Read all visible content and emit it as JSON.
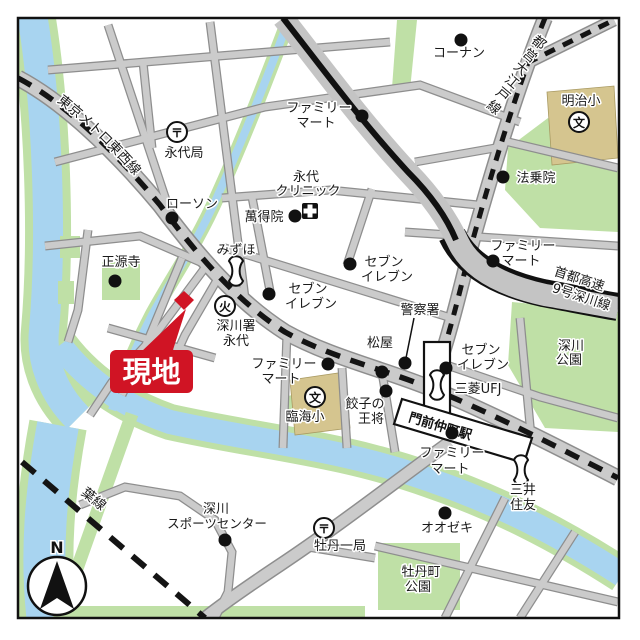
{
  "map": {
    "site": {
      "label": "現地"
    },
    "compass": {
      "north": "N"
    },
    "railways": {
      "tozai": "東京メトロ東西線",
      "oedo": "都営大江戸線",
      "oedo_chars": [
        "都",
        "営",
        "大",
        "江",
        "戸",
        "線"
      ],
      "keiyo": "京葉線",
      "expressway": [
        "首都高速",
        "9号深川線"
      ]
    },
    "station": {
      "name": "門前仲町駅"
    },
    "icons": {
      "post_office": "〒",
      "fire_station": "火",
      "school": "文"
    },
    "pois": {
      "konan": {
        "name": "コーナン"
      },
      "famima_top": {
        "lines": [
          "ファミリー",
          "マート"
        ]
      },
      "eidai_clinic": {
        "lines": [
          "永代",
          "クリニック"
        ]
      },
      "mantokuin": {
        "name": "萬得院"
      },
      "eidai_post": {
        "name": "永代局"
      },
      "lawson": {
        "name": "ローソン"
      },
      "hojoin": {
        "name": "法乗院"
      },
      "meiji_elementary": {
        "name": "明治小"
      },
      "famima_expressway": {
        "lines": [
          "ファミリー",
          "マート"
        ]
      },
      "shogenji": {
        "name": "正源寺"
      },
      "mizuho": {
        "name": "みずほ"
      },
      "seven_west": {
        "lines": [
          "セブン",
          "イレブン"
        ]
      },
      "seven_north": {
        "lines": [
          "セブン",
          "イレブン"
        ]
      },
      "fire_station_eitai": {
        "lines": [
          "深川署",
          "永代"
        ]
      },
      "police": {
        "name": "警察署"
      },
      "matsuya": {
        "name": "松屋"
      },
      "gyoza_ohsho": {
        "lines": [
          "餃子の",
          "王将"
        ]
      },
      "famima_center": {
        "lines": [
          "ファミリー",
          "マート"
        ]
      },
      "rinkai_elementary": {
        "name": "臨海小"
      },
      "seven_station": {
        "lines": [
          "セブン",
          "イレブン"
        ]
      },
      "mitsubishi_ufj": {
        "name": "三菱UFJ"
      },
      "fukagawa_park": {
        "lines": [
          "深川",
          "公園"
        ]
      },
      "famima_station": {
        "lines": [
          "ファミリー",
          "マート"
        ]
      },
      "mitsui_sumitomo": {
        "lines": [
          "三井",
          "住友"
        ]
      },
      "oozeki": {
        "name": "オオゼキ"
      },
      "botancho_park": {
        "lines": [
          "牡丹町",
          "公園"
        ]
      },
      "sports_center": {
        "lines": [
          "深川",
          "スポーツセンター"
        ]
      },
      "botan_post": {
        "name": "牡丹一局"
      }
    },
    "colors": {
      "site_red": "#D01424",
      "water_blue": "#A8D4F0",
      "bank_green": "#BFE0A6",
      "road_gray": "#CBCBCB",
      "building_tan": "#D5C58F"
    }
  }
}
